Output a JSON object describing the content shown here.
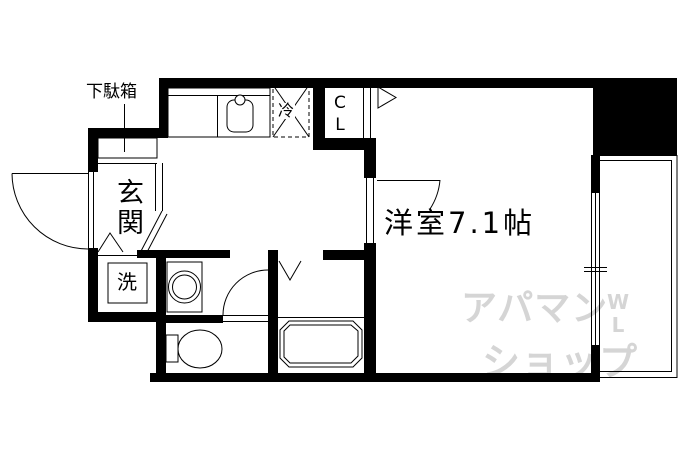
{
  "floorplan": {
    "labels": {
      "shoe_cabinet": "下駄箱",
      "entrance": "玄関",
      "refrigerator": "冷",
      "closet_top": "C",
      "closet_bottom": "L",
      "washer": "洗",
      "main_room": "洋室7.1帖"
    },
    "watermark": {
      "line1": "アパマン",
      "line2": "ショップ",
      "mark_top": "W",
      "mark_bottom": "L",
      "color": "#d5d5d5"
    },
    "colors": {
      "wall": "#000000",
      "background": "#ffffff",
      "line": "#000000"
    }
  }
}
